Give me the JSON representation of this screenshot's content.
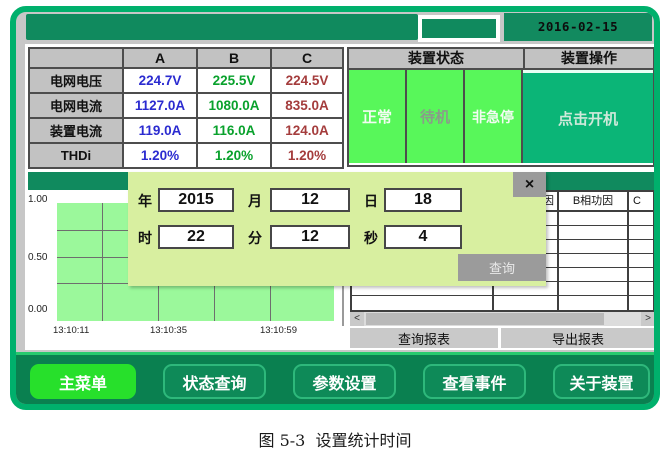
{
  "titlebar": {
    "timestamp": "2016-02-15 13:11:09"
  },
  "measurements": {
    "col_headers": [
      "A",
      "B",
      "C"
    ],
    "rows": [
      {
        "label": "电网电压",
        "a": "224.7V",
        "b": "225.5V",
        "c": "224.5V"
      },
      {
        "label": "电网电流",
        "a": "1127.0A",
        "b": "1080.0A",
        "c": "835.0A"
      },
      {
        "label": "装置电流",
        "a": "119.0A",
        "b": "116.0A",
        "c": "124.0A"
      },
      {
        "label": "THDi",
        "a": "1.20%",
        "b": "1.20%",
        "c": "1.20%"
      }
    ]
  },
  "device_panel": {
    "status_header": "装置状态",
    "operation_header": "装置操作",
    "statuses": [
      "正常",
      "待机",
      "非急停"
    ],
    "start_button": "点击开机"
  },
  "trend_chart": {
    "y_ticks": [
      "1.00",
      "0.50",
      "0.00"
    ],
    "x_ticks": [
      "13:10:11",
      "13:10:35",
      "13:10:59"
    ]
  },
  "report": {
    "header_partial_left": "因",
    "header_b": "B相功因",
    "header_partial_right": "C",
    "query_button": "查询报表",
    "export_button": "导出报表",
    "scroll_left": "<",
    "scroll_right": ">"
  },
  "dialog": {
    "close": "×",
    "year_label": "年",
    "year_value": "2015",
    "month_label": "月",
    "month_value": "12",
    "day_label": "日",
    "day_value": "18",
    "hour_label": "时",
    "hour_value": "22",
    "minute_label": "分",
    "minute_value": "12",
    "second_label": "秒",
    "second_value": "4",
    "query_button": "查询"
  },
  "nav": {
    "main_menu": "主菜单",
    "status_query": "状态查询",
    "param_set": "参数设置",
    "view_events": "查看事件",
    "about_device": "关于装置"
  },
  "caption": "图 5-3  设置统计时间",
  "colors": {
    "frame_green": "#00b06c",
    "bar_green": "#108a5e",
    "status_cell_green": "#58f75a",
    "start_button_green": "#0bb577",
    "dialog_bg": "#d8efa0",
    "chart_bg": "#9bf89b",
    "nav_bg": "#0a8050",
    "nav_active_green": "#27e02b",
    "col_a_blue": "#2b2bd0",
    "col_b_green": "#09a12c",
    "col_c_red": "#a43c3c"
  }
}
